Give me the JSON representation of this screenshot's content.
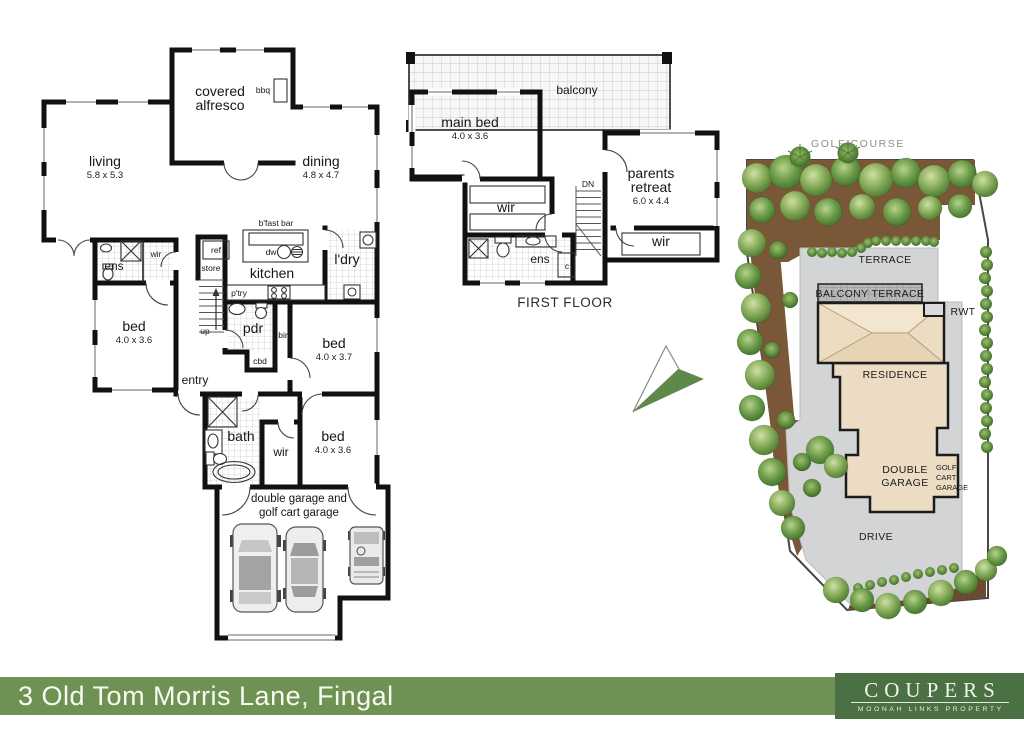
{
  "ground_floor": {
    "covered_1": "covered",
    "covered_2": "alfresco",
    "bbq": "bbq",
    "living": "living",
    "living_dims": "5.8 x 5.3",
    "dining": "dining",
    "dining_dims": "4.8 x 4.7",
    "bfast_bar": "b'fast bar",
    "dw": "dw",
    "ref": "ref",
    "store": "store",
    "kitchen": "kitchen",
    "ptry": "p'try",
    "ldry": "l'dry",
    "ens": "ens",
    "wir_ens": "wir",
    "bed1": "bed",
    "bed1_dims": "4.0 x 3.6",
    "up": "up",
    "pdr": "pdr",
    "cbd": "cbd",
    "bir": "bir",
    "bed2": "bed",
    "bed2_dims": "4.0 x 3.7",
    "entry": "entry",
    "bath": "bath",
    "wir_bed3": "wir",
    "bed3": "bed",
    "bed3_dims": "4.0 x 3.6",
    "garage_1": "double garage and",
    "garage_2": "golf cart garage"
  },
  "first_floor": {
    "balcony": "balcony",
    "main_bed": "main bed",
    "main_bed_dims": "4.0 x 3.6",
    "parents_1": "parents",
    "parents_2": "retreat",
    "parents_dims": "6.0 x 4.4",
    "dn": "DN",
    "wir_main": "wir",
    "ens": "ens",
    "closet": "c",
    "wir_parents": "wir",
    "title": "FIRST FLOOR"
  },
  "site_plan": {
    "golf_course": "GOLF COURSE",
    "terrace": "TERRACE",
    "balcony_terrace": "BALCONY TERRACE",
    "rwt": "RWT",
    "residence": "RESIDENCE",
    "double_garage_1": "DOUBLE",
    "double_garage_2": "GARAGE",
    "golf_cart_1": "GOLF",
    "golf_cart_2": "CART",
    "golf_cart_3": "GARAGE",
    "drive": "DRIVE",
    "colors": {
      "paving": "#D2D4D6",
      "garden_bed": "#7A5837",
      "roof": "#F0E3CB",
      "footprint": "#EBDCC3",
      "tree_light": "#CFE0A4",
      "tree_mid": "#7EA956",
      "tree_dark": "#4C7A33",
      "arrow_green": "#5D8A4B"
    }
  },
  "banner": {
    "address": "3 Old Tom Morris Lane, Fingal",
    "bar_color": "#6E9254",
    "logo": {
      "bg": "#4A7044",
      "title": "COUPERS",
      "subtitle": "MOONAH LINKS PROPERTY"
    }
  }
}
